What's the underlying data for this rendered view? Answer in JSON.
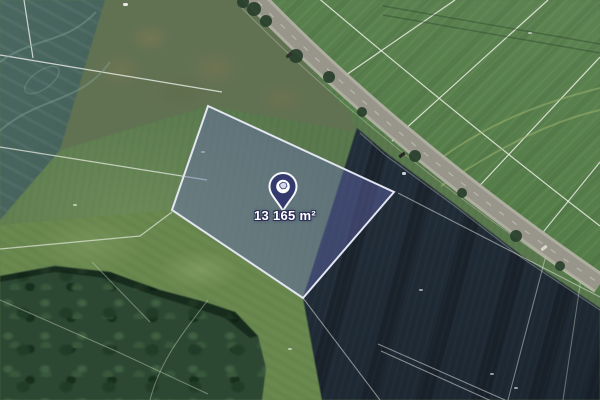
{
  "map": {
    "view_type": "satellite",
    "marker": {
      "area_label": "13 165 m²",
      "icon": "location-pin-icon",
      "pin_fill": "#343a6e",
      "pin_ring": "#ffffff"
    },
    "parcel": {
      "fill": "#6a6eb8",
      "border": "#e3e6f2"
    },
    "terrain_colors": {
      "field_green": "#5a7a4e",
      "plowed_field_dark": "#222e39",
      "forest_green": "#2c4833",
      "road_gray": "#98968b",
      "cadastral_line": "#eef0e8"
    }
  }
}
